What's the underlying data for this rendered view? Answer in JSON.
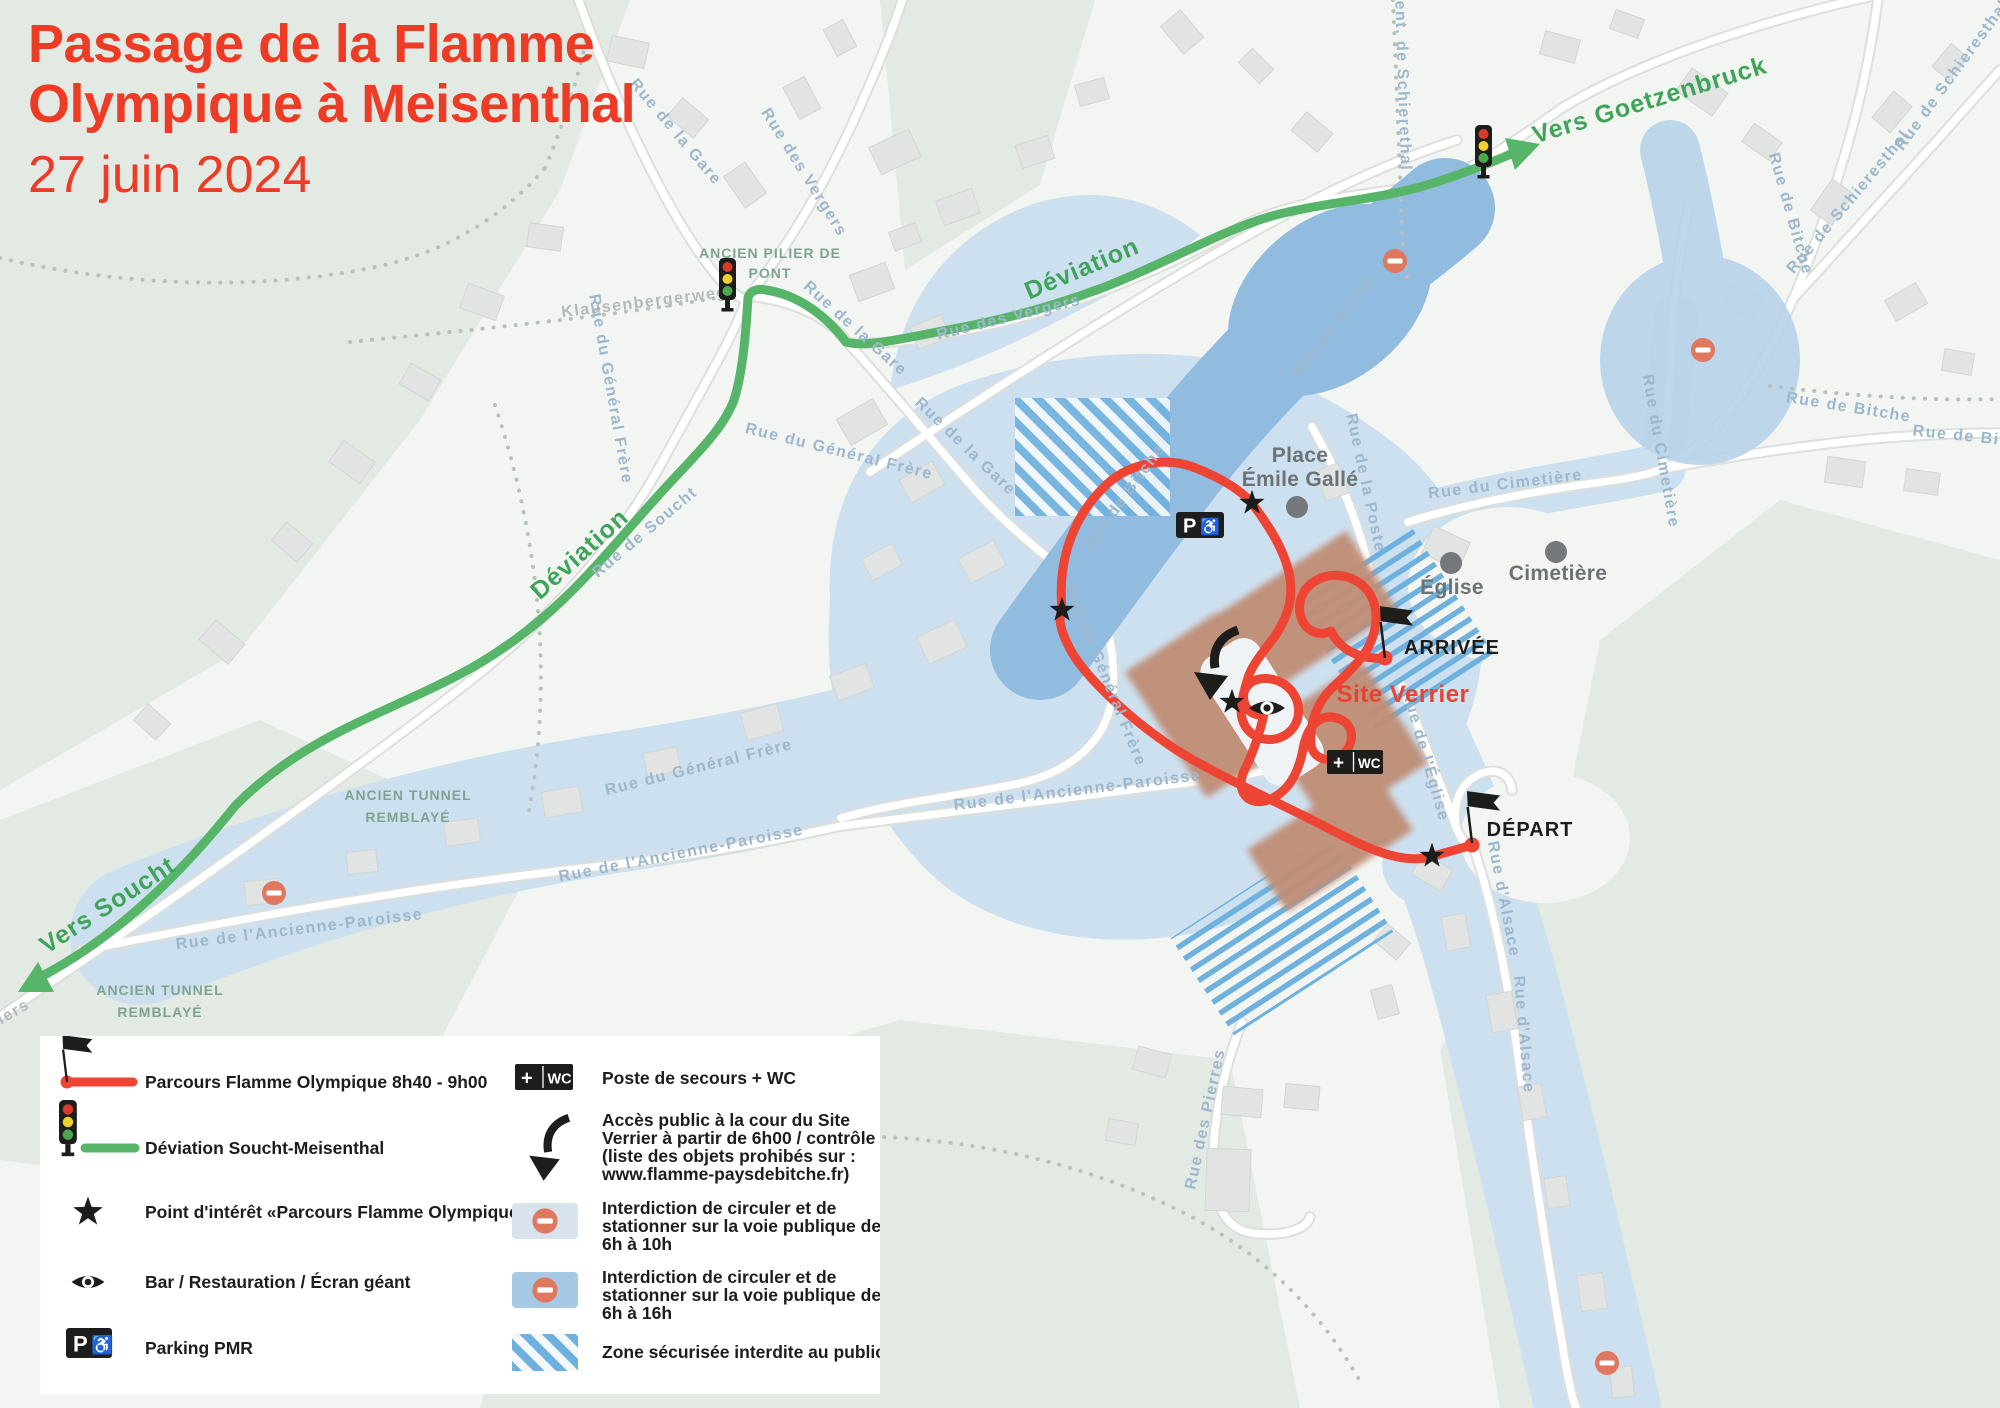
{
  "title": {
    "line1": "Passage de la Flamme",
    "line2": "Olympique à Meisenthal",
    "date": "27 juin 2024"
  },
  "map": {
    "directions": {
      "goetzenbruck": "Vers Goetzenbruck",
      "soucht": "Vers Soucht",
      "deviation_west": "Déviation",
      "deviation_north": "Déviation"
    },
    "poi": {
      "place_line1": "Place",
      "place_line2": "Émile Gallé",
      "eglise": "Église",
      "cimetiere": "Cimetière",
      "site_verrier": "Site Verrier",
      "arrivee": "ARRIVÉE",
      "depart": "DÉPART"
    },
    "captions": {
      "pilier_line1": "ANCIEN PILIER DE",
      "pilier_line2": "PONT",
      "tunnel_line1": "ANCIEN TUNNEL",
      "tunnel_line2": "REMBLAYÉ"
    },
    "streets": [
      "Rue de la Gare",
      "Rue des Vergers",
      "Rue des Vergers",
      "Rue de la Gare",
      "Rue de la Gare",
      "Klausenbergerweg",
      "Rue de Soucht",
      "Rue du Général Frère",
      "Rue du Général Frère",
      "Rue du Général Frère",
      "Rue du Général Frère",
      "Rue de l'Ancienne-Paroisse",
      "Rue de l'Ancienne-Paroisse",
      "Rue de l'Ancienne-Paroisse",
      "Rue de Bitche",
      "Rue de Bitche",
      "Rue de Bitche",
      "Rue de Bitche",
      "Rue de Bitche",
      "Rue de Schieresthal",
      "Rue de Schieresthal",
      "Sent. de Schierethal",
      "Rue du Cimetière",
      "Rue du Cimetière",
      "Rue de la Poste",
      "Rue de l'Église",
      "Rue d'Alsace",
      "Rue d'Alsace",
      "Rue des Pierres",
      "iers"
    ],
    "badges": {
      "parking_p": "P",
      "wheelchair": "♿",
      "plus": "+",
      "wc": "WC"
    }
  },
  "legend": {
    "parcours": "Parcours Flamme Olympique 8h40 - 9h00",
    "deviation": "Déviation Soucht-Meisenthal",
    "point_interet": "Point d'intérêt «Parcours Flamme Olympique»",
    "bar": "Bar / Restauration / Écran géant",
    "parking": "Parking PMR",
    "poste": "Poste de secours + WC",
    "acces_lines": [
      "Accès public à la cour du Site",
      "Verrier à partir de 6h00 / contrôle",
      "(liste des objets prohibés sur :",
      "www.flamme-paysdebitche.fr)"
    ],
    "interdiction_10h_lines": [
      "Interdiction de circuler et de",
      "stationner sur la voie publique de",
      "6h à 10h"
    ],
    "interdiction_16h_lines": [
      "Interdiction de circuler et de",
      "stationner sur la voie publique de",
      "6h à 16h"
    ],
    "zone": "Zone sécurisée interdite au public"
  },
  "colors": {
    "accent_red": "#ee3b26",
    "route_red": "#ee4433",
    "route_green": "#57b569",
    "zone_blue_light": "#cde0ef",
    "zone_blue_dark": "#91bcdf",
    "site_brown": "#c08e77",
    "no_entry": "#e0775f"
  }
}
